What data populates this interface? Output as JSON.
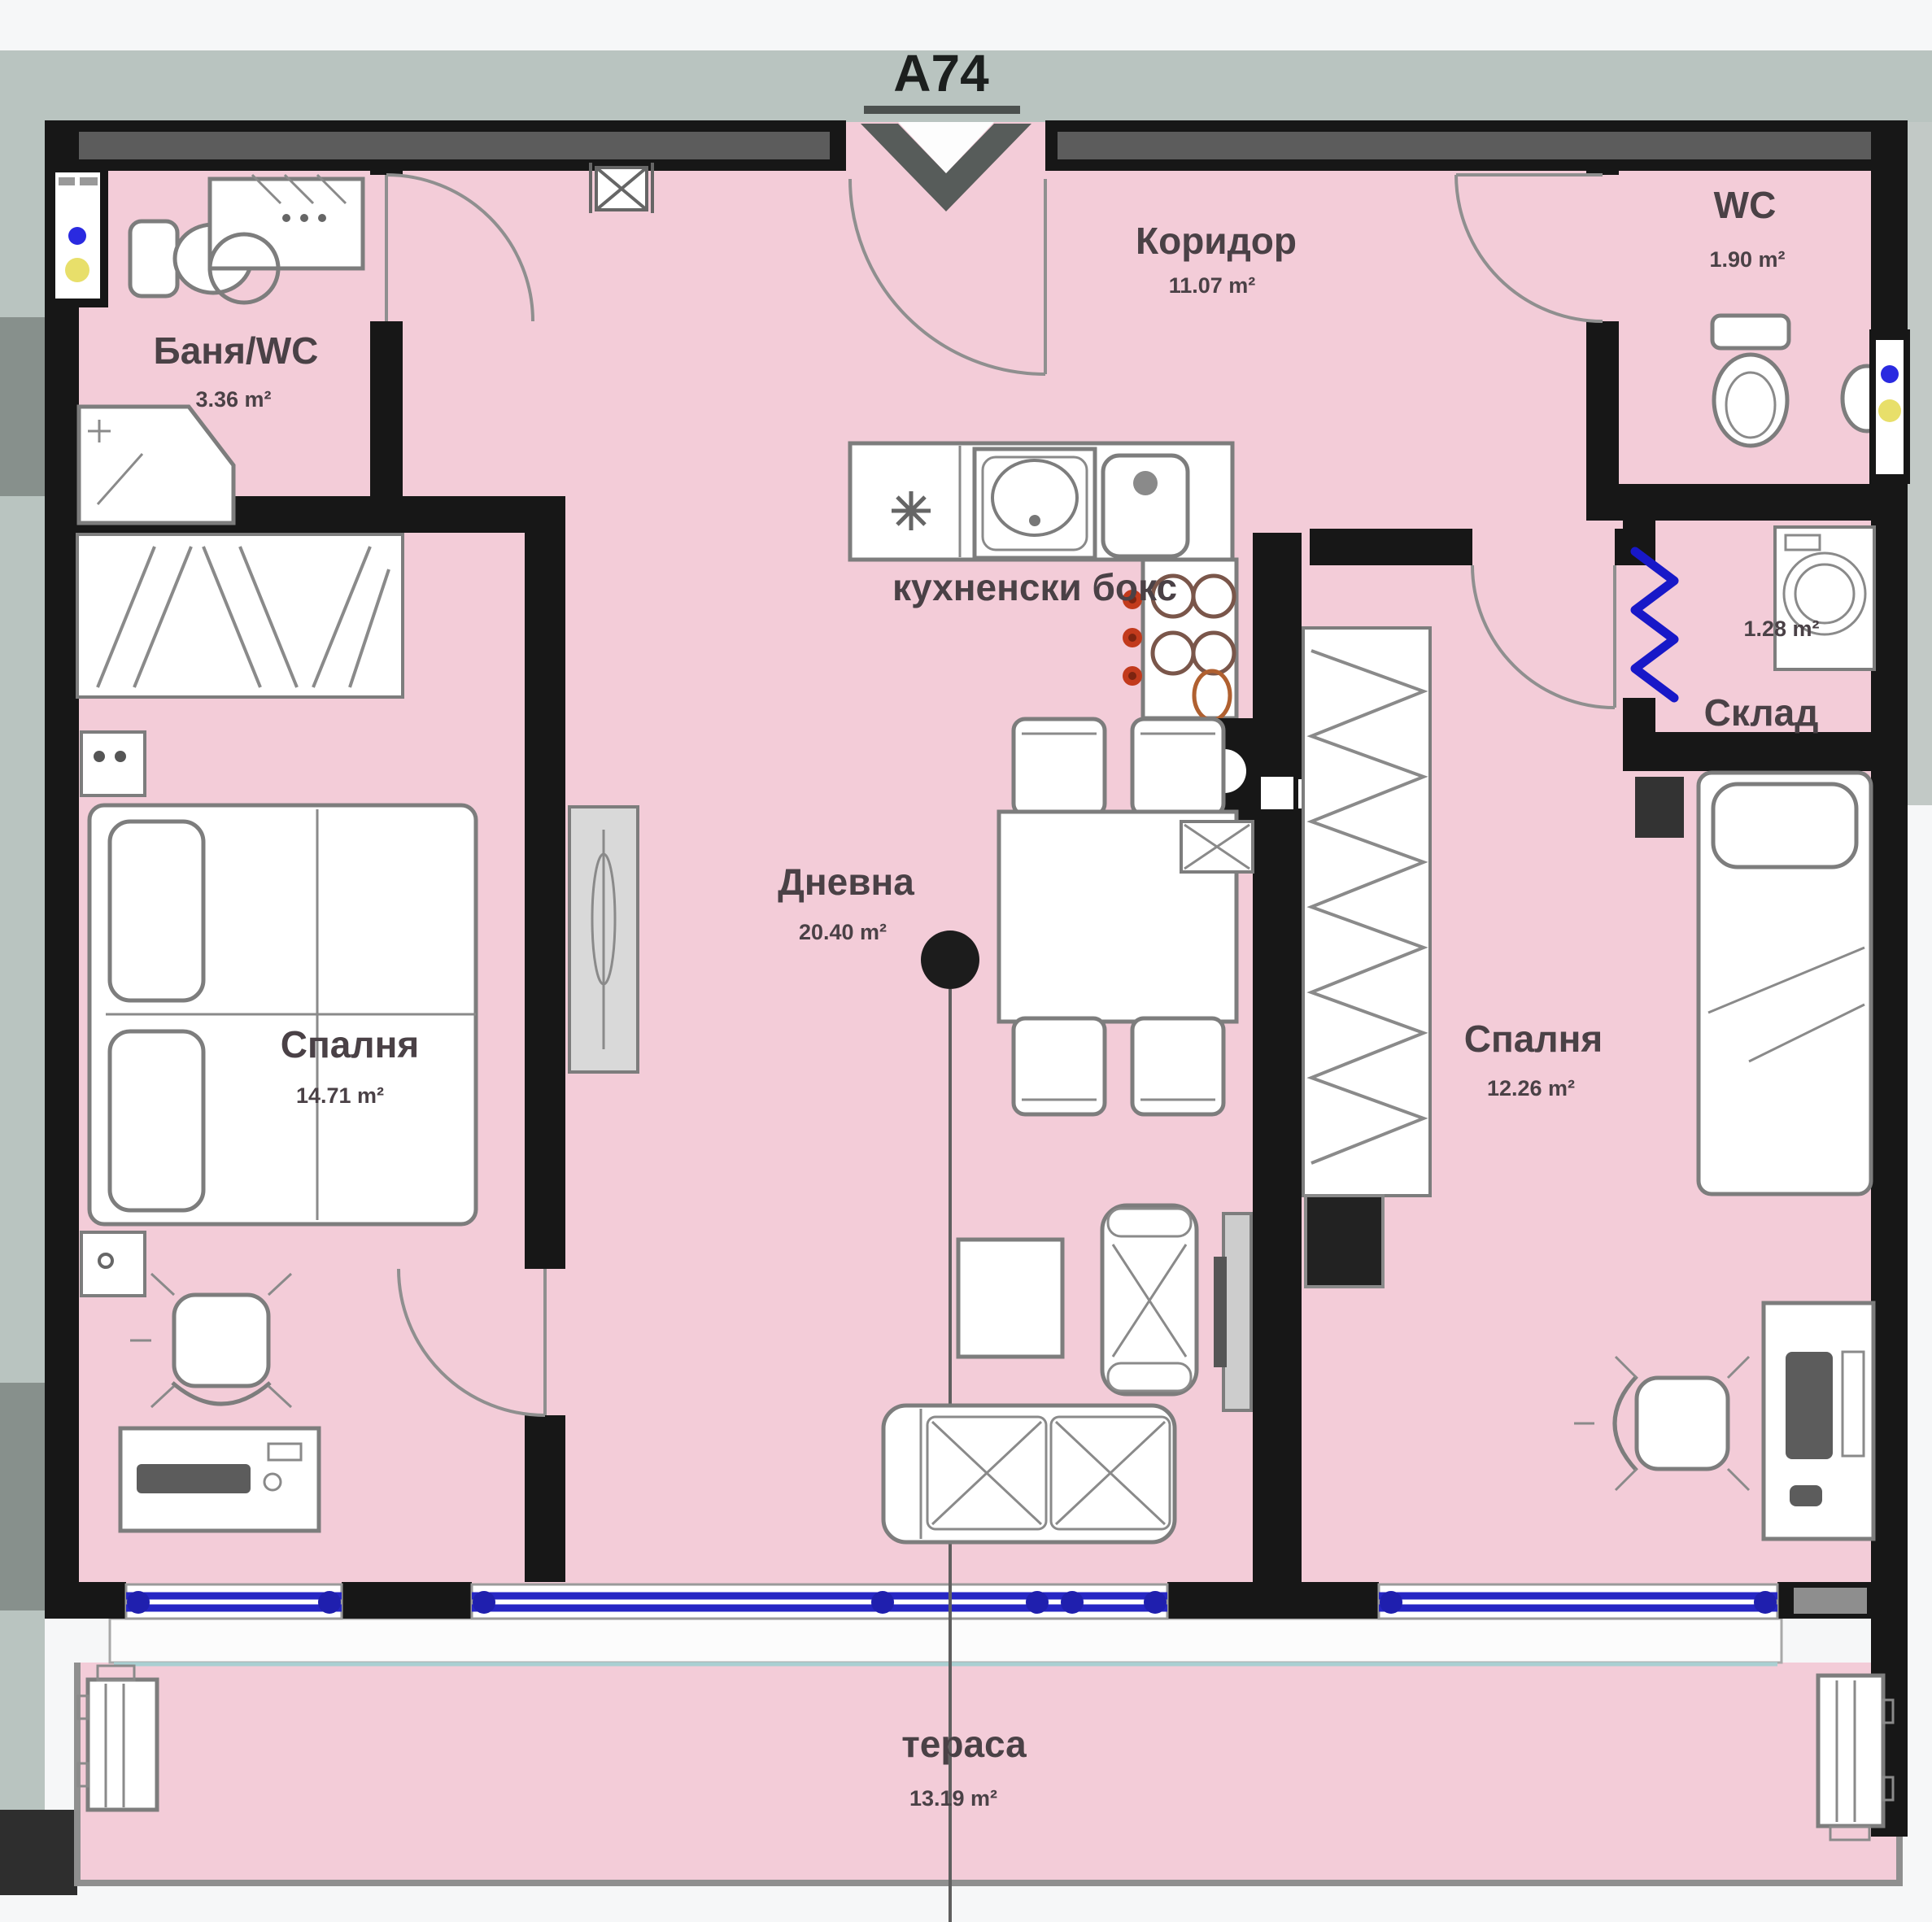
{
  "plan": {
    "title": "A74",
    "kitchen_label": "кухненски бокс",
    "rooms": {
      "bathroom": {
        "name": "Баня/WC",
        "area": "3.36 m²"
      },
      "corridor": {
        "name": "Коридор",
        "area": "11.07 m²"
      },
      "wc": {
        "name": "WC",
        "area": "1.90 m²"
      },
      "storage": {
        "name": "Склад",
        "area": "1.28 m²"
      },
      "bedroom_left": {
        "name": "Спалня",
        "area": "14.71 m²"
      },
      "living": {
        "name": "Дневна",
        "area": "20.40 m²"
      },
      "bedroom_right": {
        "name": "Спалня",
        "area": "12.26 m²"
      },
      "terrace": {
        "name": "тераса",
        "area": "13.19 m²"
      }
    },
    "colors": {
      "floor_pink": "#f3ccd8",
      "exterior_gray": "#b9c4c0",
      "wall_black": "#171717",
      "wall_gray_fill": "#5c5c5c",
      "window_blue": "#2626c4",
      "storage_door_blue": "#1818c8",
      "furniture_gray": "#7d7d7d",
      "burner_knob_red": "#c23a1c",
      "shaft_yellow": "#ece27d",
      "label_color": "#4a4146",
      "title_color": "#1c1f1e"
    }
  }
}
